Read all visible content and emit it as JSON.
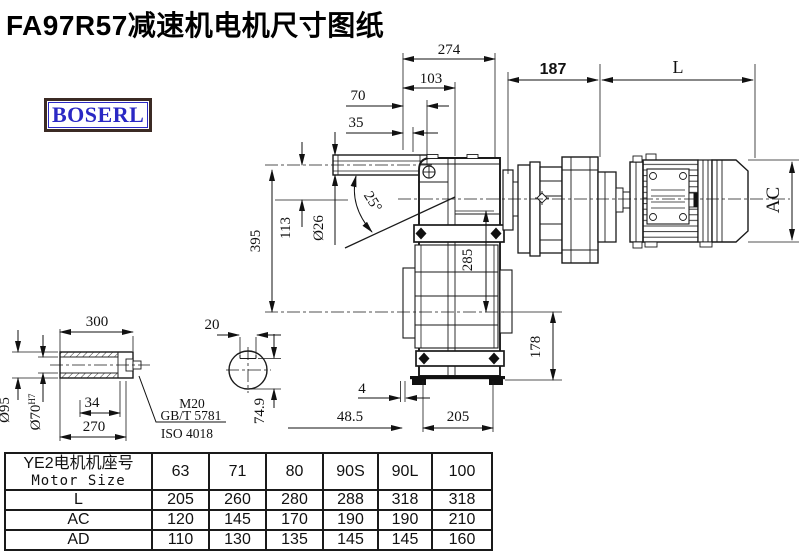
{
  "title": "FA97R57减速机电机尺寸图纸",
  "logo_text": "BOSERL",
  "drawing": {
    "dims": {
      "d274": "274",
      "d103": "103",
      "d70": "70",
      "d35": "35",
      "d187": "187",
      "dL": "L",
      "d395": "395",
      "d113": "113",
      "d26": "Ø26",
      "d25": "25°",
      "d285": "285",
      "d178": "178",
      "dAC": "AC",
      "d4": "4",
      "d48_5": "48.5",
      "d205": "205",
      "d300": "300",
      "d95": "Ø95",
      "d70h7": "Ø70",
      "d70h7_tol": "H7",
      "d34": "34",
      "d270": "270",
      "m20": "M20",
      "gbt5781": "GB/T 5781",
      "iso4018": "ISO 4018",
      "d20": "20",
      "d74_9": "74.9"
    }
  },
  "table": {
    "header_cn": "YE2电机机座号",
    "header_en": "Motor Size",
    "sizes": [
      "63",
      "71",
      "80",
      "90S",
      "90L",
      "100"
    ],
    "rows": [
      {
        "label": "L",
        "values": [
          "205",
          "260",
          "280",
          "288",
          "318",
          "318"
        ]
      },
      {
        "label": "AC",
        "values": [
          "120",
          "145",
          "170",
          "190",
          "190",
          "210"
        ]
      },
      {
        "label": "AD",
        "values": [
          "110",
          "130",
          "135",
          "145",
          "145",
          "160"
        ]
      }
    ]
  }
}
